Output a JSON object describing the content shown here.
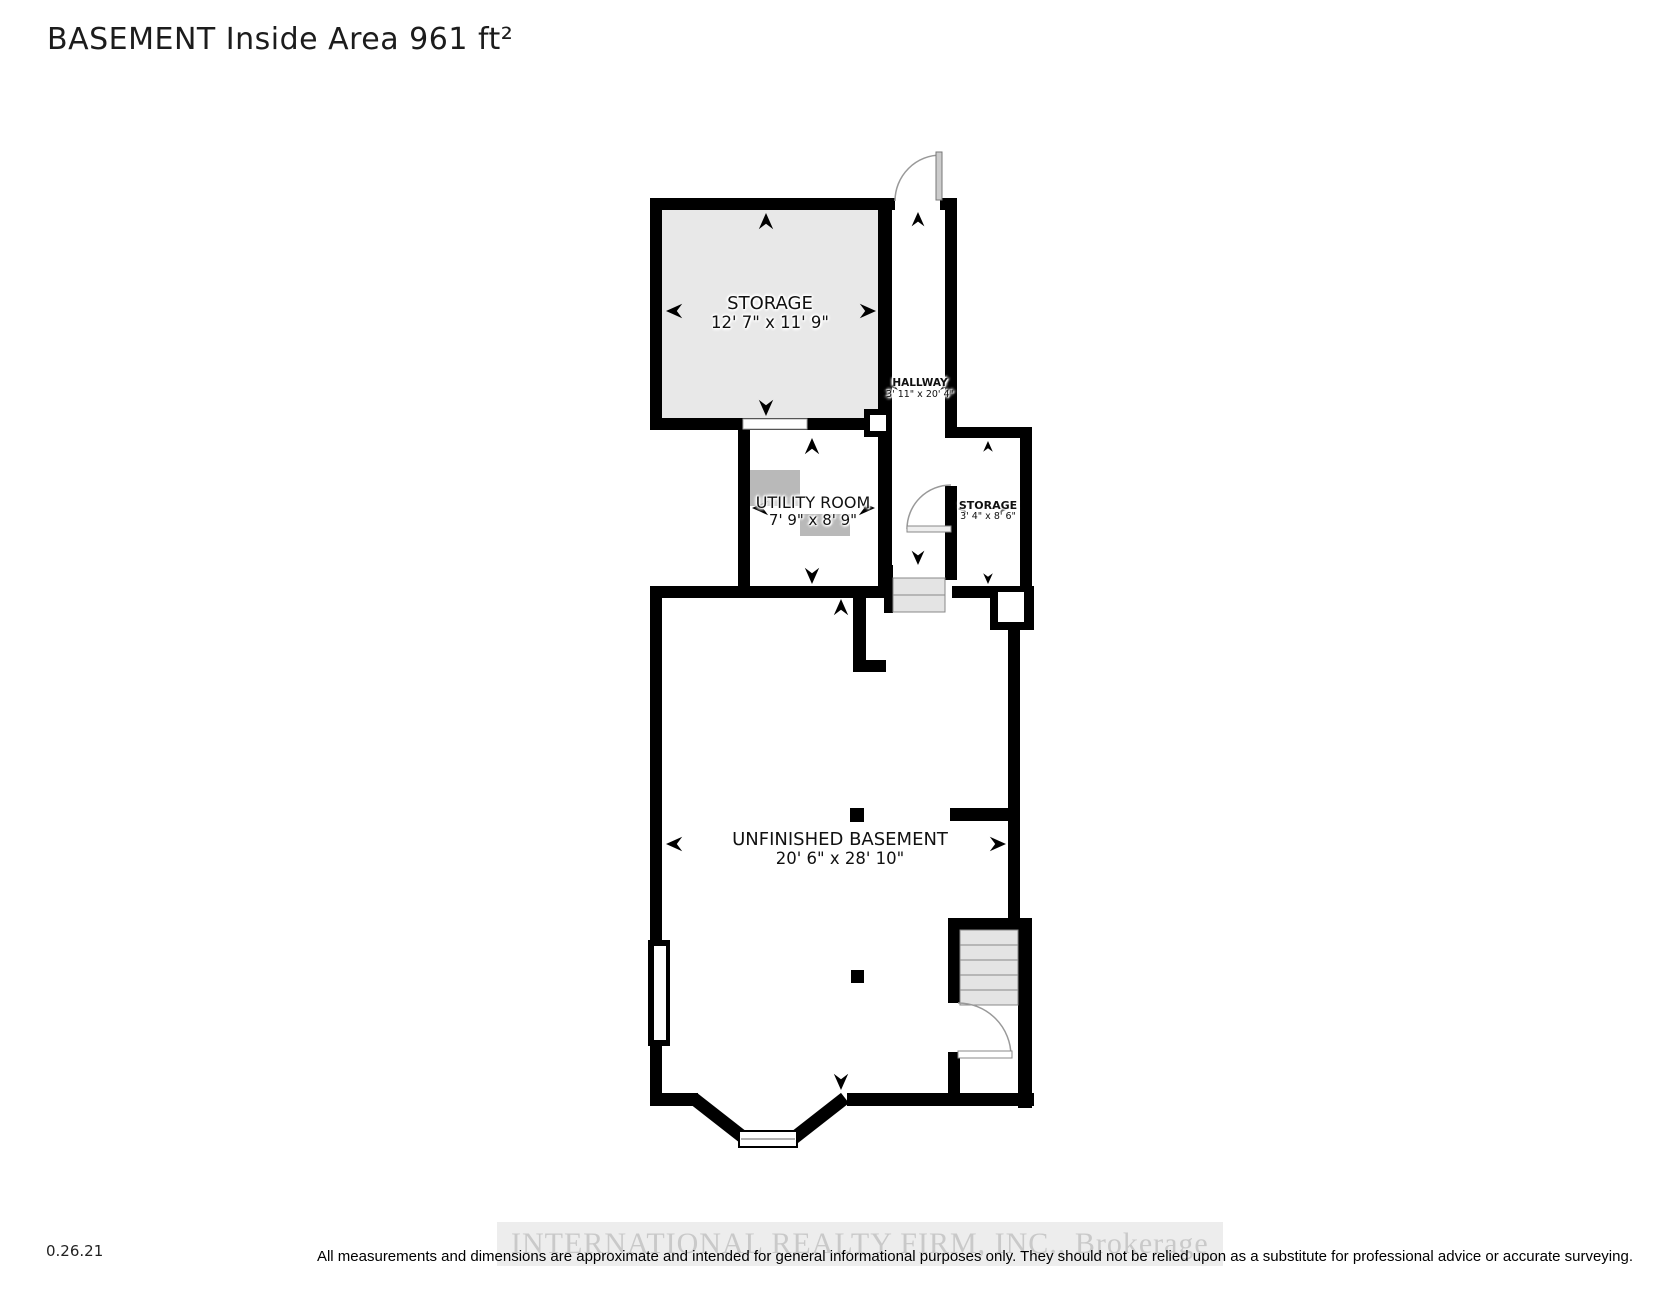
{
  "header": {
    "title": "BASEMENT Inside Area 961 ft²"
  },
  "rooms": {
    "storage_main": {
      "name": "STORAGE",
      "dims": "12' 7\" x 11' 9\""
    },
    "hallway": {
      "name": "HALLWAY",
      "dims": "3' 11\" x 20' 4\""
    },
    "utility": {
      "name": "UTILITY ROOM",
      "dims": "7' 9\" x 8' 9\""
    },
    "storage_small": {
      "name": "STORAGE",
      "dims": "3' 4\" x 8' 6\""
    },
    "basement": {
      "name": "UNFINISHED BASEMENT",
      "dims": "20' 6\" x 28' 10\""
    }
  },
  "footer": {
    "date": "0.26.21",
    "watermark": "INTERNATIONAL REALTY FIRM, INC., Brokerage",
    "disclaimer": "All measurements and dimensions are approximate and intended for general informational purposes only. They should not be relied upon as a substitute for professional advice or accurate surveying."
  },
  "colors": {
    "wall": "#000000",
    "storage_fill": "#e8e8e8",
    "stairs_fill": "#e4e4e4",
    "equipment": "#b9b9b9",
    "door_arc": "#999999",
    "watermark_text": "#c9c9c9",
    "watermark_band": "#ededed"
  }
}
